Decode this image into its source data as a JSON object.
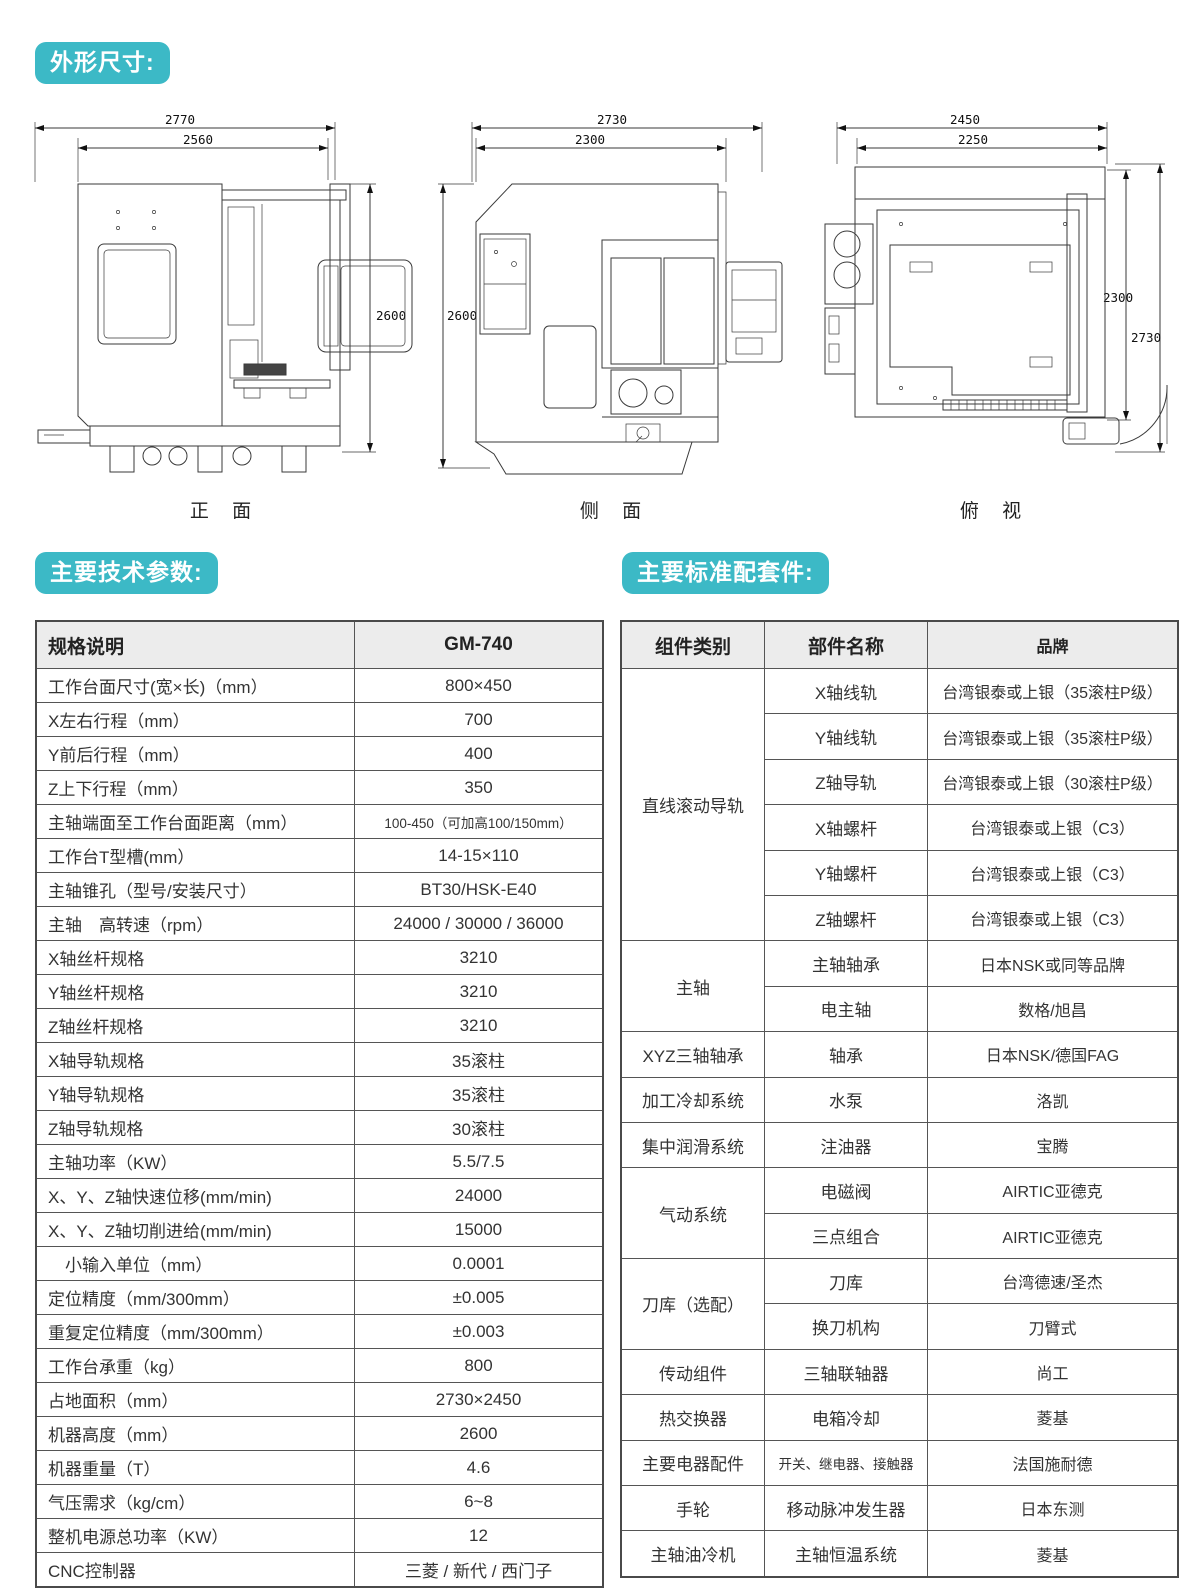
{
  "sections": {
    "dimensions_title": "外形尺寸:",
    "specs_title": "主要技术参数:",
    "parts_title": "主要标准配套件:"
  },
  "drawings": {
    "front": {
      "caption": "正 面",
      "dims": {
        "top_outer": "2770",
        "top_inner": "2560",
        "right": "2600"
      }
    },
    "side": {
      "caption": "侧 面",
      "dims": {
        "top_outer": "2730",
        "top_inner": "2300",
        "left": "2600"
      }
    },
    "top": {
      "caption": "俯 视",
      "dims": {
        "top_outer": "2450",
        "top_inner": "2250",
        "right_inner": "2300",
        "right_outer": "2730"
      }
    }
  },
  "spec_table": {
    "headers": [
      "规格说明",
      "GM-740"
    ],
    "rows": [
      [
        "工作台面尺寸(宽×长)（mm）",
        "800×450"
      ],
      [
        "X左右行程（mm）",
        "700"
      ],
      [
        "Y前后行程（mm）",
        "400"
      ],
      [
        "Z上下行程（mm）",
        "350"
      ],
      [
        "主轴端面至工作台面距离（mm）",
        "100-450（可加高100/150mm）"
      ],
      [
        "工作台T型槽(mm）",
        "14-15×110"
      ],
      [
        "主轴锥孔（型号/安装尺寸）",
        "BT30/HSK-E40"
      ],
      [
        "主轴　高转速（rpm）",
        "24000 / 30000 / 36000"
      ],
      [
        "X轴丝杆规格",
        "3210"
      ],
      [
        "Y轴丝杆规格",
        "3210"
      ],
      [
        "Z轴丝杆规格",
        "3210"
      ],
      [
        "X轴导轨规格",
        "35滚柱"
      ],
      [
        "Y轴导轨规格",
        "35滚柱"
      ],
      [
        "Z轴导轨规格",
        "30滚柱"
      ],
      [
        "主轴功率（KW）",
        "5.5/7.5"
      ],
      [
        "X、Y、Z轴快速位移(mm/min)",
        "24000"
      ],
      [
        "X、Y、Z轴切削进给(mm/min)",
        "15000"
      ],
      [
        "　小输入单位（mm）",
        "0.0001"
      ],
      [
        "定位精度（mm/300mm）",
        "±0.005"
      ],
      [
        "重复定位精度（mm/300mm）",
        "±0.003"
      ],
      [
        "工作台承重（kg）",
        "800"
      ],
      [
        "占地面积（mm）",
        "2730×2450"
      ],
      [
        "机器高度（mm）",
        "2600"
      ],
      [
        "机器重量（T）",
        "4.6"
      ],
      [
        "气压需求（kg/cm）",
        "6~8"
      ],
      [
        "整机电源总功率（KW）",
        "12"
      ],
      [
        "CNC控制器",
        "三菱 / 新代 / 西门子"
      ]
    ]
  },
  "parts_table": {
    "headers": [
      "组件类别",
      "部件名称",
      "品牌"
    ],
    "groups": [
      {
        "category": "直线滚动导轨",
        "items": [
          [
            "X轴线轨",
            "台湾银泰或上银（35滚柱P级）"
          ],
          [
            "Y轴线轨",
            "台湾银泰或上银（35滚柱P级）"
          ],
          [
            "Z轴导轨",
            "台湾银泰或上银（30滚柱P级）"
          ],
          [
            "X轴螺杆",
            "台湾银泰或上银（C3）"
          ],
          [
            "Y轴螺杆",
            "台湾银泰或上银（C3）"
          ],
          [
            "Z轴螺杆",
            "台湾银泰或上银（C3）"
          ]
        ]
      },
      {
        "category": "主轴",
        "items": [
          [
            "主轴轴承",
            "日本NSK或同等品牌"
          ],
          [
            "电主轴",
            "数格/旭昌"
          ]
        ]
      },
      {
        "category": "XYZ三轴轴承",
        "items": [
          [
            "轴承",
            "日本NSK/德国FAG"
          ]
        ]
      },
      {
        "category": "加工冷却系统",
        "items": [
          [
            "水泵",
            "洛凯"
          ]
        ]
      },
      {
        "category": "集中润滑系统",
        "items": [
          [
            "注油器",
            "宝腾"
          ]
        ]
      },
      {
        "category": "气动系统",
        "items": [
          [
            "电磁阀",
            "AIRTIC亚德克"
          ],
          [
            "三点组合",
            "AIRTIC亚德克"
          ]
        ]
      },
      {
        "category": "刀库（选配）",
        "items": [
          [
            "刀库",
            "台湾德速/圣杰"
          ],
          [
            "换刀机构",
            "刀臂式"
          ]
        ]
      },
      {
        "category": "传动组件",
        "items": [
          [
            "三轴联轴器",
            "尚工"
          ]
        ]
      },
      {
        "category": "热交换器",
        "items": [
          [
            "电箱冷却",
            "菱基"
          ]
        ]
      },
      {
        "category": "主要电器配件",
        "items": [
          [
            "开关、继电器、接触器",
            "法国施耐德"
          ]
        ]
      },
      {
        "category": "手轮",
        "items": [
          [
            "移动脉冲发生器",
            "日本东测"
          ]
        ]
      },
      {
        "category": "主轴油冷机",
        "items": [
          [
            "主轴恒温系统",
            "菱基"
          ]
        ]
      }
    ]
  },
  "colors": {
    "accent_teal": "#3cb9c6",
    "table_border": "#555555",
    "table_header_bg": "#ececec",
    "text": "#333333"
  }
}
